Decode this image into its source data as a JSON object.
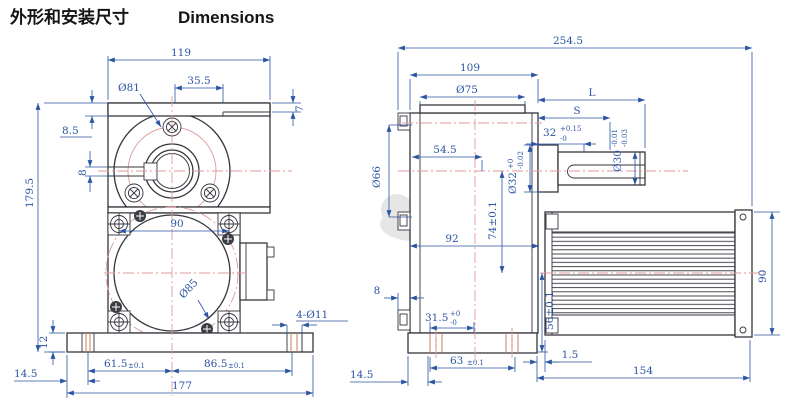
{
  "title": {
    "zh": "外形和安装尺寸",
    "en": "Dimensions"
  },
  "colors": {
    "dimension_blue": "#2b55a3",
    "outline_dark": "#35353d",
    "centerline_red": "#e09a9a",
    "slot_orange": "#c87f5e",
    "hatch_blue": "#8585c2",
    "background": "#ffffff",
    "watermark_gray": "#d2d2d2"
  },
  "front_view": {
    "dims": {
      "top_width": "119",
      "step_width": "35.5",
      "step_height": "7",
      "flange_thickness": "8.5",
      "gear_bolt_circle": "Ø81",
      "bore_keyway_width": "8",
      "overall_height": "179.5",
      "screw_spacing": "90",
      "motor_face_dia": "Ø85",
      "foot_slots": "4-Ø11",
      "base_thickness": "12",
      "slot_edge_offset": "14.5",
      "slot_to_center": {
        "value": "61.5",
        "tol": "±0.1"
      },
      "center_to_slot": {
        "value": "86.5",
        "tol": "±0.1"
      },
      "base_width": "177"
    }
  },
  "side_view": {
    "dims": {
      "overall_length": "254.5",
      "gearbox_width": "109",
      "top_boss_dia": "Ø75",
      "shaft_length": "L",
      "key_length": "S",
      "key_cut": {
        "value": "32",
        "sup": "+0.15",
        "sub": "-0"
      },
      "face_to_axis": "54.5",
      "hub_dia": {
        "value": "Ø32",
        "sup": "+0",
        "sub": "-0.02"
      },
      "shaft_dia": {
        "value": "Ø30",
        "sup": "-0.01",
        "sub": "-0.03"
      },
      "axis_to_motor_axis": "74±0.1",
      "housing_depth": "92",
      "lug_thickness": "8",
      "base_inset": {
        "value": "31.5",
        "sup": "+0",
        "sub": "-0"
      },
      "motor_axis_to_base": "56±0.1",
      "side_boss_dia": "Ø66",
      "base_slot_span": {
        "value": "63",
        "tol": "±0.1"
      },
      "base_to_motor_gap": "1.5",
      "motor_length": "154",
      "slot_edge_offset": "14.5",
      "motor_height": "90"
    }
  }
}
